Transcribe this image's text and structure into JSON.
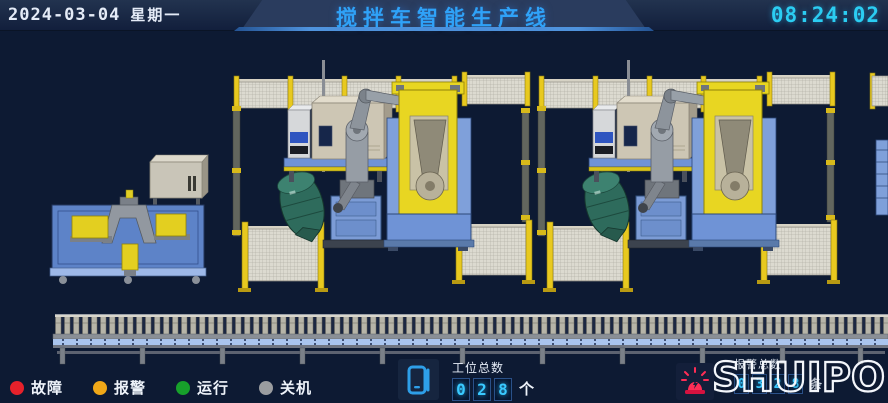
{
  "header": {
    "date": "2024-03-04",
    "weekday": "星期一",
    "title": "搅拌车智能生产线",
    "time": "08:24:02"
  },
  "status_legend": {
    "items": [
      {
        "name": "fault",
        "label": "故障",
        "color": "#e6212b"
      },
      {
        "name": "warning",
        "label": "报警",
        "color": "#f0a818"
      },
      {
        "name": "running",
        "label": "运行",
        "color": "#17a02b"
      },
      {
        "name": "off",
        "label": "关机",
        "color": "#9b9da0"
      }
    ]
  },
  "station_counter": {
    "label": "工位总数",
    "digits": [
      "0",
      "2",
      "8"
    ],
    "unit": "个"
  },
  "alarm_counter": {
    "label": "报警总数",
    "digits": [
      "0",
      "3",
      "2",
      "8"
    ],
    "unit": "条"
  },
  "brand": {
    "logo": "SHUIPO"
  },
  "scene": {
    "cabinet_label": "KUKA",
    "colors": {
      "background": "#0d1a33",
      "title_accent": "#2fa2f8",
      "clock_accent": "#2bcdf2",
      "digit_accent": "#39c9ff",
      "fence_post": "#e8c91f",
      "robot_positioner": "#e8d622",
      "machine_base": "#5d83c8",
      "drum": "#2e6b5c",
      "siren": "#ff2d55"
    }
  }
}
